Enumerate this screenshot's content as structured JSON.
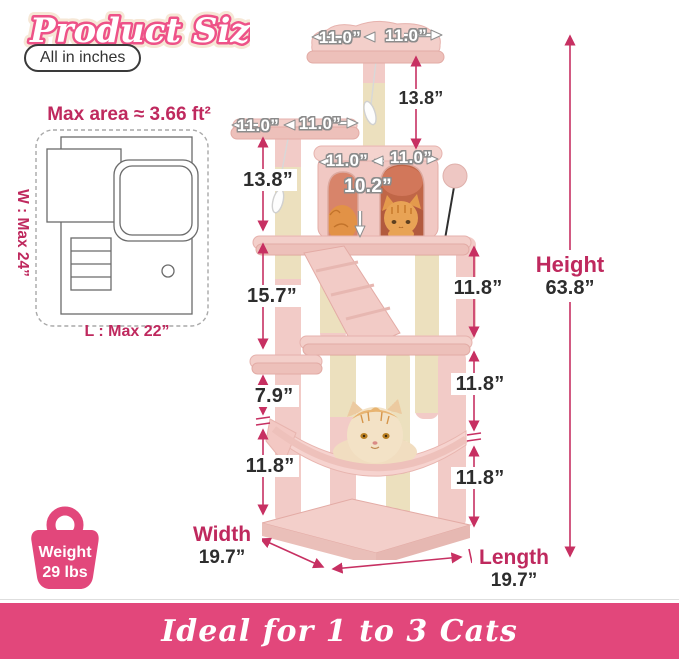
{
  "title": "Product Size",
  "badge": "All in inches",
  "footprint": {
    "area_label": "Max area ≈ 3.66 ft²",
    "width_label": "W : Max 24”",
    "length_label": "L : Max 22”"
  },
  "tree_labels": {
    "top_perch_left": "11.0”",
    "top_perch_right": "11.0”",
    "mid_perch_left": "11.0”",
    "mid_perch_right": "11.0”",
    "condo_left": "11.0”",
    "condo_right": "11.0”",
    "condo_inner_height": "10.2”"
  },
  "measurements": {
    "top_post": "13.8”",
    "left_upper": "13.8”",
    "left_middle": "15.7”",
    "left_lower": "7.9”",
    "left_bottom": "11.8”",
    "right_upper": "11.8”",
    "right_middle": "11.8”",
    "right_bottom": "11.8”",
    "height_label": "Height",
    "height_value": "63.8”",
    "width_label": "Width",
    "width_value": "19.7”",
    "length_label": "Length",
    "length_value": "19.7”"
  },
  "weight": {
    "line1": "Weight",
    "line2": "29 lbs"
  },
  "banner": "Ideal for 1 to 3 Cats",
  "colors": {
    "accent_pink": "#e2477b",
    "dimension_line": "#c73062",
    "label_crimson": "#bf295e",
    "text_dark": "#2d2d2d",
    "plush_pink": "#f2cbc7",
    "sisal_cream": "#f1e7c8",
    "title_pink": "#ee5288"
  }
}
